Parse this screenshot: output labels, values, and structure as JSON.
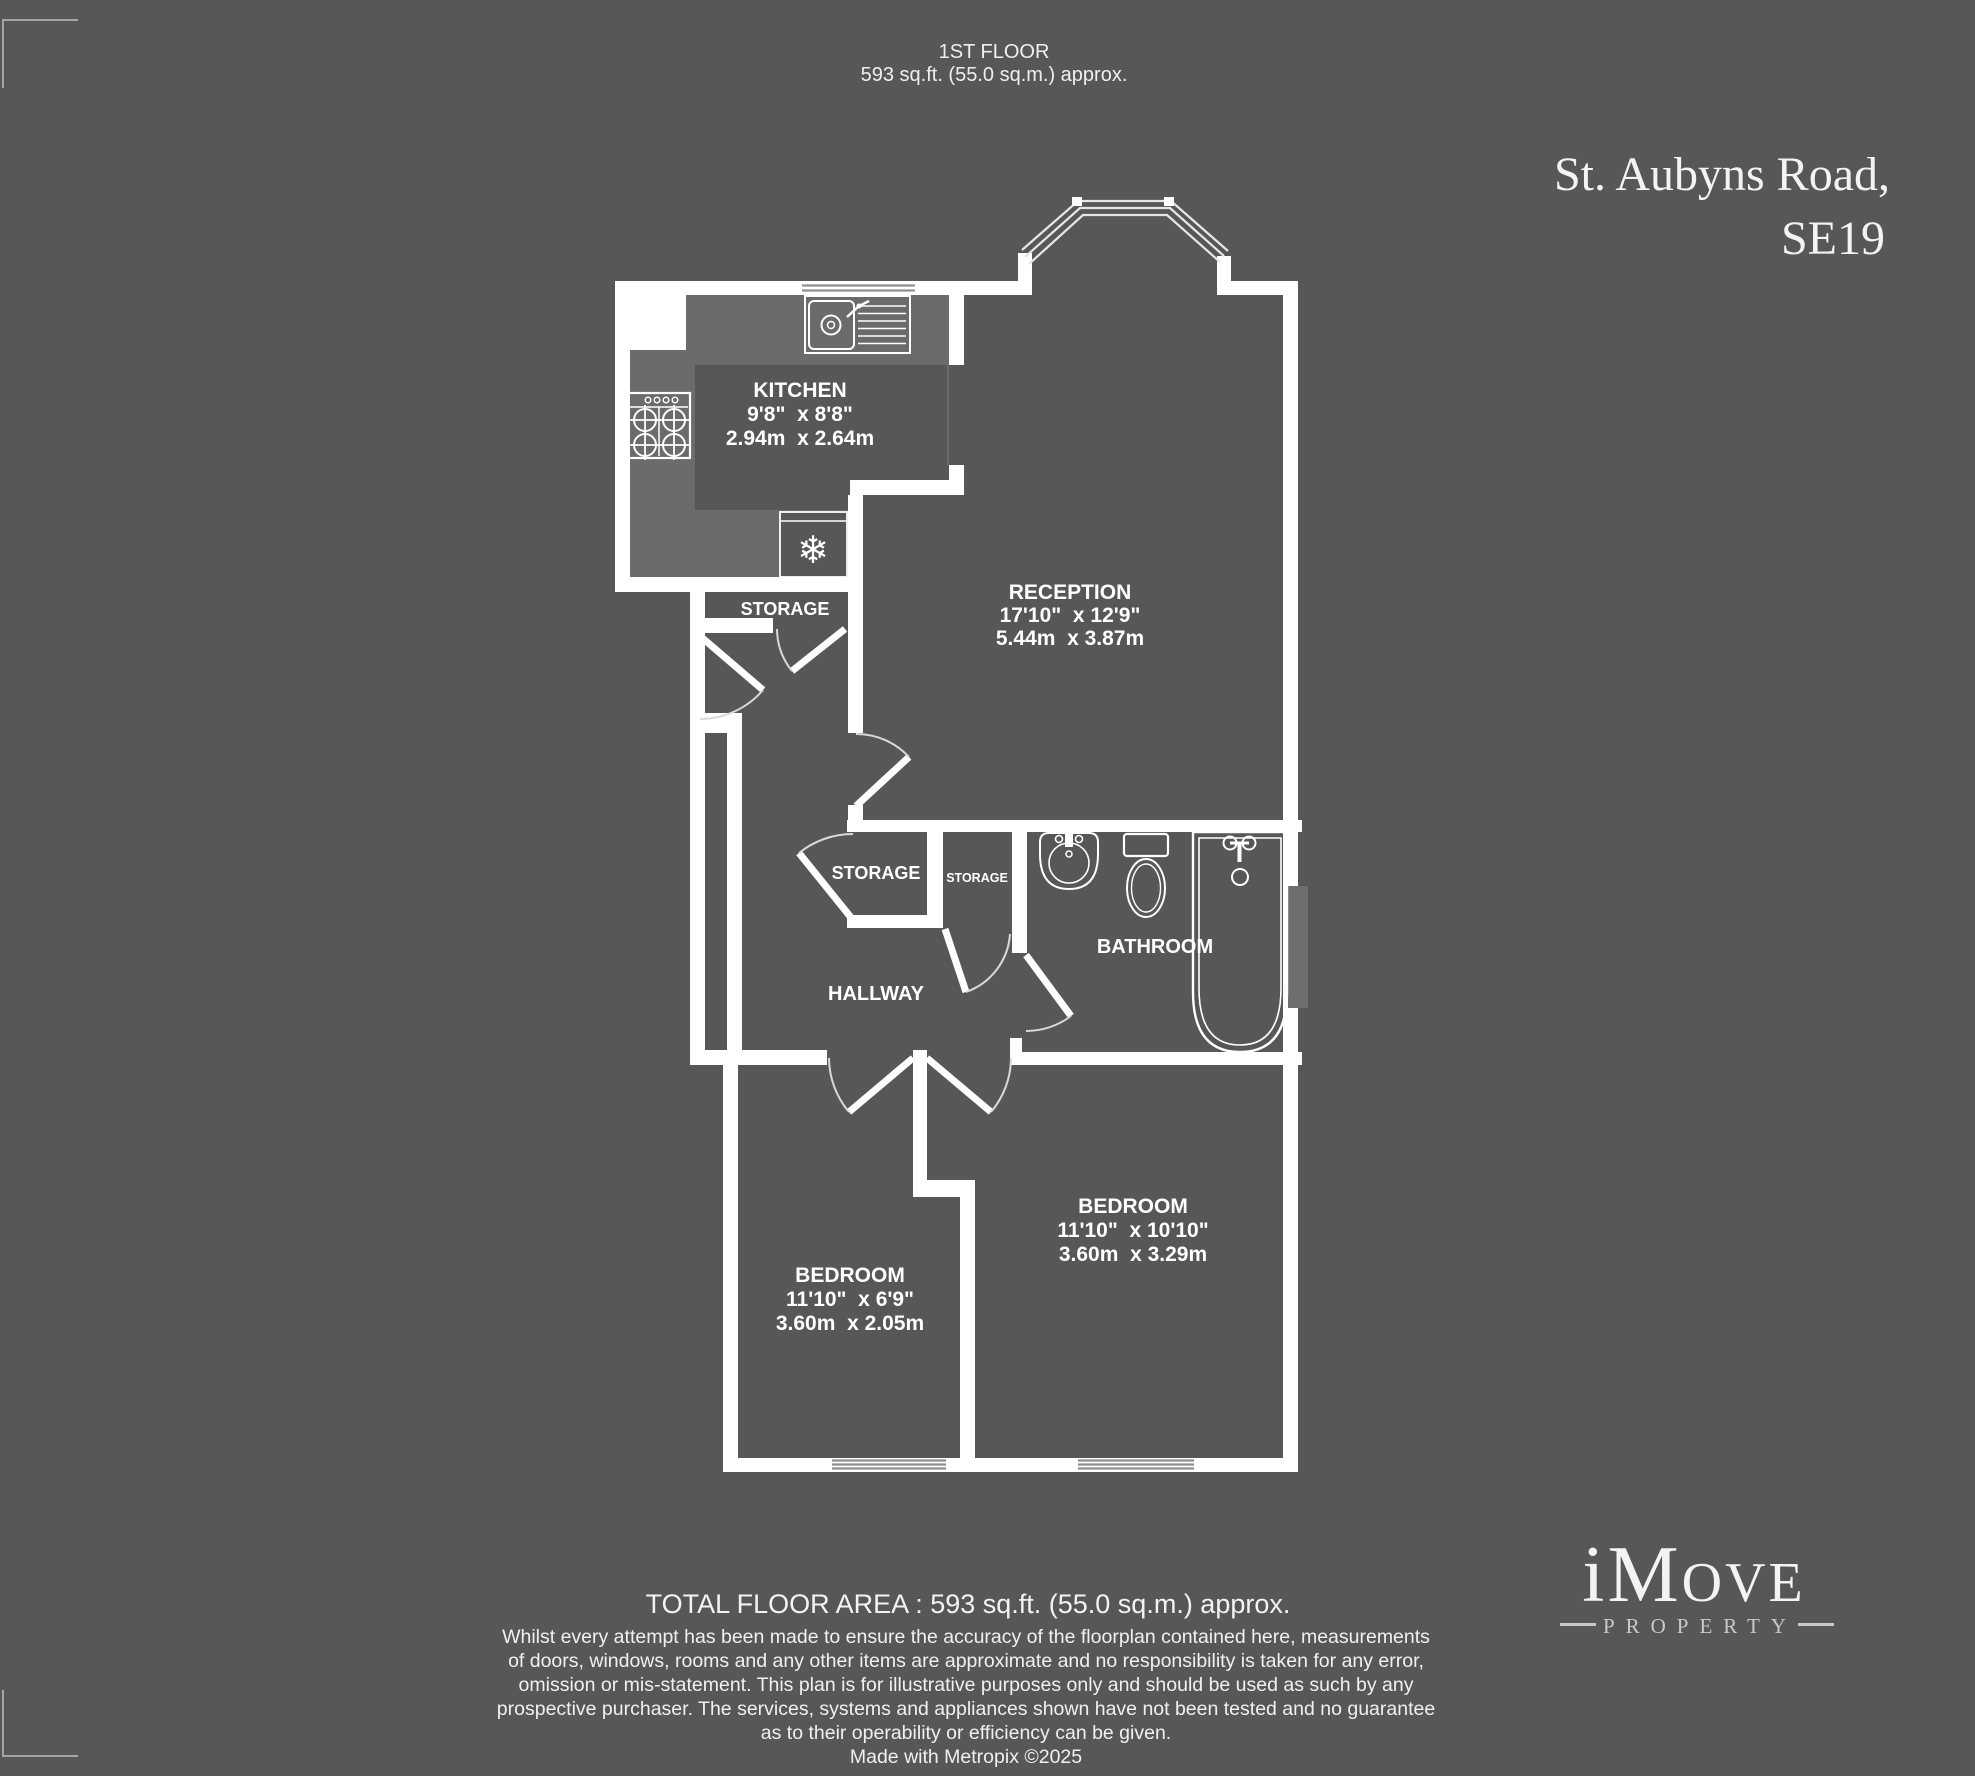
{
  "colors": {
    "background": "#575757",
    "wall": "#ffffff",
    "kitchen_floor": "#6b6b6b",
    "label_text": "#ffffff",
    "accent_text": "#f3f3f3",
    "logo_tagline": "#c9c9c9"
  },
  "header": {
    "floor_label": "1ST FLOOR",
    "floor_area": "593 sq.ft. (55.0 sq.m.) approx."
  },
  "address": {
    "line1": "St. Aubyns Road,",
    "line2": "SE19"
  },
  "rooms": {
    "kitchen": {
      "name": "KITCHEN",
      "imperial": "9'8\"  x 8'8\"",
      "metric": "2.94m  x 2.64m"
    },
    "reception": {
      "name": "RECEPTION",
      "imperial": "17'10\"  x 12'9\"",
      "metric": "5.44m  x 3.87m"
    },
    "storage_top": {
      "name": "STORAGE"
    },
    "storage_left": {
      "name": "STORAGE"
    },
    "storage_right": {
      "name": "STORAGE"
    },
    "hallway": {
      "name": "HALLWAY"
    },
    "bathroom": {
      "name": "BATHROOM"
    },
    "bedroom_right": {
      "name": "BEDROOM",
      "imperial": "11'10\"  x 10'10\"",
      "metric": "3.60m  x 3.29m"
    },
    "bedroom_left": {
      "name": "BEDROOM",
      "imperial": "11'10\"  x 6'9\"",
      "metric": "3.60m  x 2.05m"
    }
  },
  "icons": {
    "fridge_snowflake": "❄"
  },
  "footer": {
    "total_area": "TOTAL FLOOR AREA : 593 sq.ft. (55.0 sq.m.) approx.",
    "disclaimer_lines": [
      "Whilst every attempt has been made to ensure the accuracy of the floorplan contained here, measurements",
      "of doors, windows, rooms and any other items are approximate and no responsibility is taken for any error,",
      "omission or mis-statement. This plan is for illustrative purposes only and should be used as such by any",
      "prospective purchaser. The services, systems and appliances shown have not been tested and no guarantee",
      "as to their operability or efficiency can be given."
    ],
    "made_with": "Made with Metropix ©2025"
  },
  "logo": {
    "prefix": "iM",
    "suffix": "OVE",
    "tagline": "PROPERTY"
  }
}
